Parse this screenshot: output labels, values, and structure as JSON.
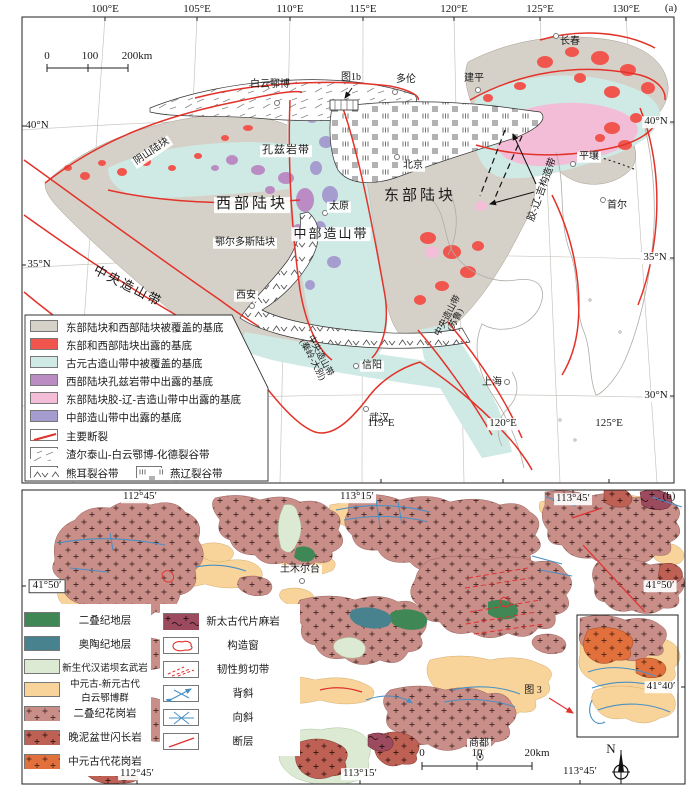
{
  "panel_a": {
    "tag": "(a)",
    "axis_top": [
      "100°E",
      "105°E",
      "110°E",
      "115°E",
      "120°E",
      "125°E",
      "130°E"
    ],
    "axis_bottom": [
      "115°E",
      "120°E",
      "125°E"
    ],
    "lat_left": [
      "40°N",
      "35°N"
    ],
    "lat_right": [
      "40°N",
      "35°N",
      "30°N"
    ],
    "scalebar": {
      "t0": "0",
      "t1": "100",
      "t2": "200km"
    },
    "inset_ref": "图1b",
    "cities": {
      "baiyun_obo": "白云鄂博",
      "duolun": "多伦",
      "jianping": "建平",
      "changchun": "长春",
      "beijing": "北京",
      "taiyuan": "太原",
      "xian": "西安",
      "xinyang": "信阳",
      "wuhan": "武汉",
      "shanghai": "上海",
      "pyongyang": "平壤",
      "seoul": "首尔"
    },
    "regions": {
      "yinshan": "阴山陆块",
      "khondalite": "孔兹岩带",
      "western": "西部陆块",
      "eastern": "东部陆块",
      "central": "中部造山带",
      "ordos": "鄂尔多斯陆块",
      "cob": "中央造山带",
      "qinling_l1": "中央造山带",
      "qinling_l2": "(秦岭-大别)",
      "sulu_l1": "中央造山带",
      "sulu_l2": "(苏鲁)",
      "jlj": "胶-辽-吉构造带"
    },
    "legend": [
      {
        "label": "东部陆块和西部陆块被覆盖的基底",
        "color": "#d6d1c8"
      },
      {
        "label": "东部和西部陆块出露的基底",
        "color": "#f0564d"
      },
      {
        "label": "古元古造山带中被覆盖的基底",
        "color": "#cfe9e4"
      },
      {
        "label": "西部陆块孔兹岩带中出露的基底",
        "color": "#bb8cc3"
      },
      {
        "label": "东部陆块胶-辽-吉造山带中出露的基底",
        "color": "#f3bcd7"
      },
      {
        "label": "中部造山带中出露的基底",
        "color": "#a59dd0"
      },
      {
        "label": "主要断裂",
        "color": "#e2332a"
      },
      {
        "label": "渣尔泰山-白云鄂博-化德裂谷带"
      },
      {
        "label": "熊耳裂谷带"
      },
      {
        "label": "燕辽裂谷带"
      }
    ]
  },
  "panel_b": {
    "tag": "(b)",
    "axis_top": [
      "112°45′",
      "113°15′",
      "113°45′"
    ],
    "axis_bottom": [
      "112°45′",
      "113°15′",
      "113°45′"
    ],
    "lat_left": [
      "41°50′"
    ],
    "lat_right": [
      "41°50′",
      "41°40′"
    ],
    "scalebar": {
      "t0": "0",
      "t1": "10",
      "t2": "20km"
    },
    "towns": {
      "tumuertai": "土木尔台",
      "shangdu": "商都"
    },
    "inset_ref": "图 3",
    "north": "N",
    "legend_left": [
      {
        "label": "二叠纪地层",
        "color": "#3f8755"
      },
      {
        "label": "奥陶纪地层",
        "color": "#47828e"
      },
      {
        "label": "新生代汉诺坝玄武岩",
        "color": "#dcead3"
      },
      {
        "label_l1": "中元古-新元古代",
        "label_l2": "白云鄂博群",
        "color": "#f8d49a"
      },
      {
        "label": "二叠纪花岗岩",
        "color": "#c98e88",
        "pattern": "plus"
      },
      {
        "label": "晚泥盆世闪长岩",
        "color": "#bf6055",
        "pattern": "plus"
      },
      {
        "label": "中元古代花岗岩",
        "color": "#e2703d",
        "pattern": "plus"
      }
    ],
    "legend_right": [
      {
        "label": "新太古代片麻岩",
        "color": "#9c4a5e",
        "pattern": "plus-tilde"
      },
      {
        "label": "构造窗",
        "symbol": "tectonic-window"
      },
      {
        "label": "韧性剪切带",
        "symbol": "ductile-shear-zone"
      },
      {
        "label": "背斜",
        "symbol": "anticline"
      },
      {
        "label": "向斜",
        "symbol": "syncline"
      },
      {
        "label": "断层",
        "symbol": "fault"
      }
    ]
  },
  "colors": {
    "fault_red": "#e2332a",
    "fold_axis_blue": "#4a90c4",
    "coast_grey": "#b0aca6",
    "covered_basement": "#d6d1c8",
    "exposed_basement": "#f0564d",
    "paleoproterozoic_cyan": "#cfe9e4",
    "khondalite_purple": "#bb8cc3",
    "jiao_liao_ji_pink": "#f3bcd7",
    "central_orogen_lavender": "#a59dd0",
    "permian_green": "#3f8755",
    "ordovician_teal": "#47828e",
    "hannuoba_basalt": "#dcead3",
    "bayan_obo_group": "#f8d49a",
    "permian_granite": "#c98e88",
    "devonian_diorite": "#bf6055",
    "mesoproterozoic_granite": "#e2703d",
    "neoarchean_gneiss": "#9c4a5e"
  }
}
